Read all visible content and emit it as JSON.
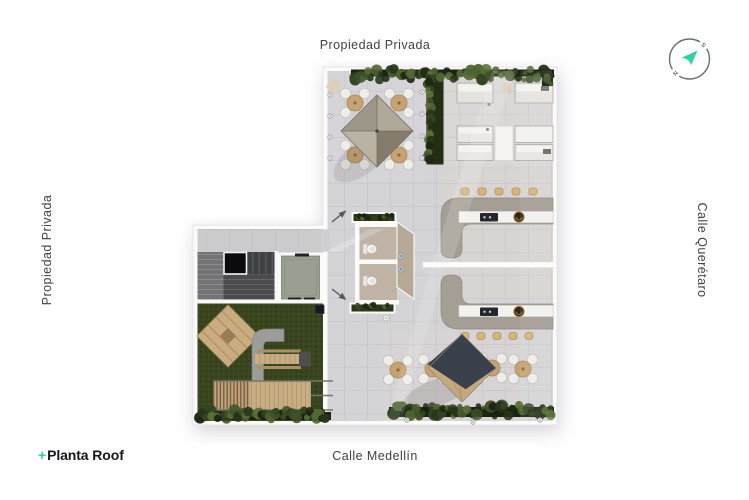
{
  "labels": {
    "top": "Propiedad Privada",
    "left": "Propiedad Privada",
    "right": "Calle Querétaro",
    "bottom": "Calle Medellín"
  },
  "logo": {
    "plus": "+",
    "name": "Planta Roof"
  },
  "compass": {
    "north": "N",
    "south": "S"
  },
  "colors": {
    "accent_teal": "#2fd0a9",
    "label_text": "#41414b",
    "logo_text": "#16161c",
    "compass_ring": "#676d79",
    "paving": "#d4d3d6",
    "lawn_green": "#39451f",
    "hedge_green": "#2c3a1c",
    "bar_gray": "#a49e95",
    "countertop_white": "#f3f2ef",
    "wood_tan": "#c9ae85",
    "sail_gray_north": "#9d978a",
    "sail_dark_south": "#3a414d",
    "sail_tan_south": "#c4a97e"
  }
}
